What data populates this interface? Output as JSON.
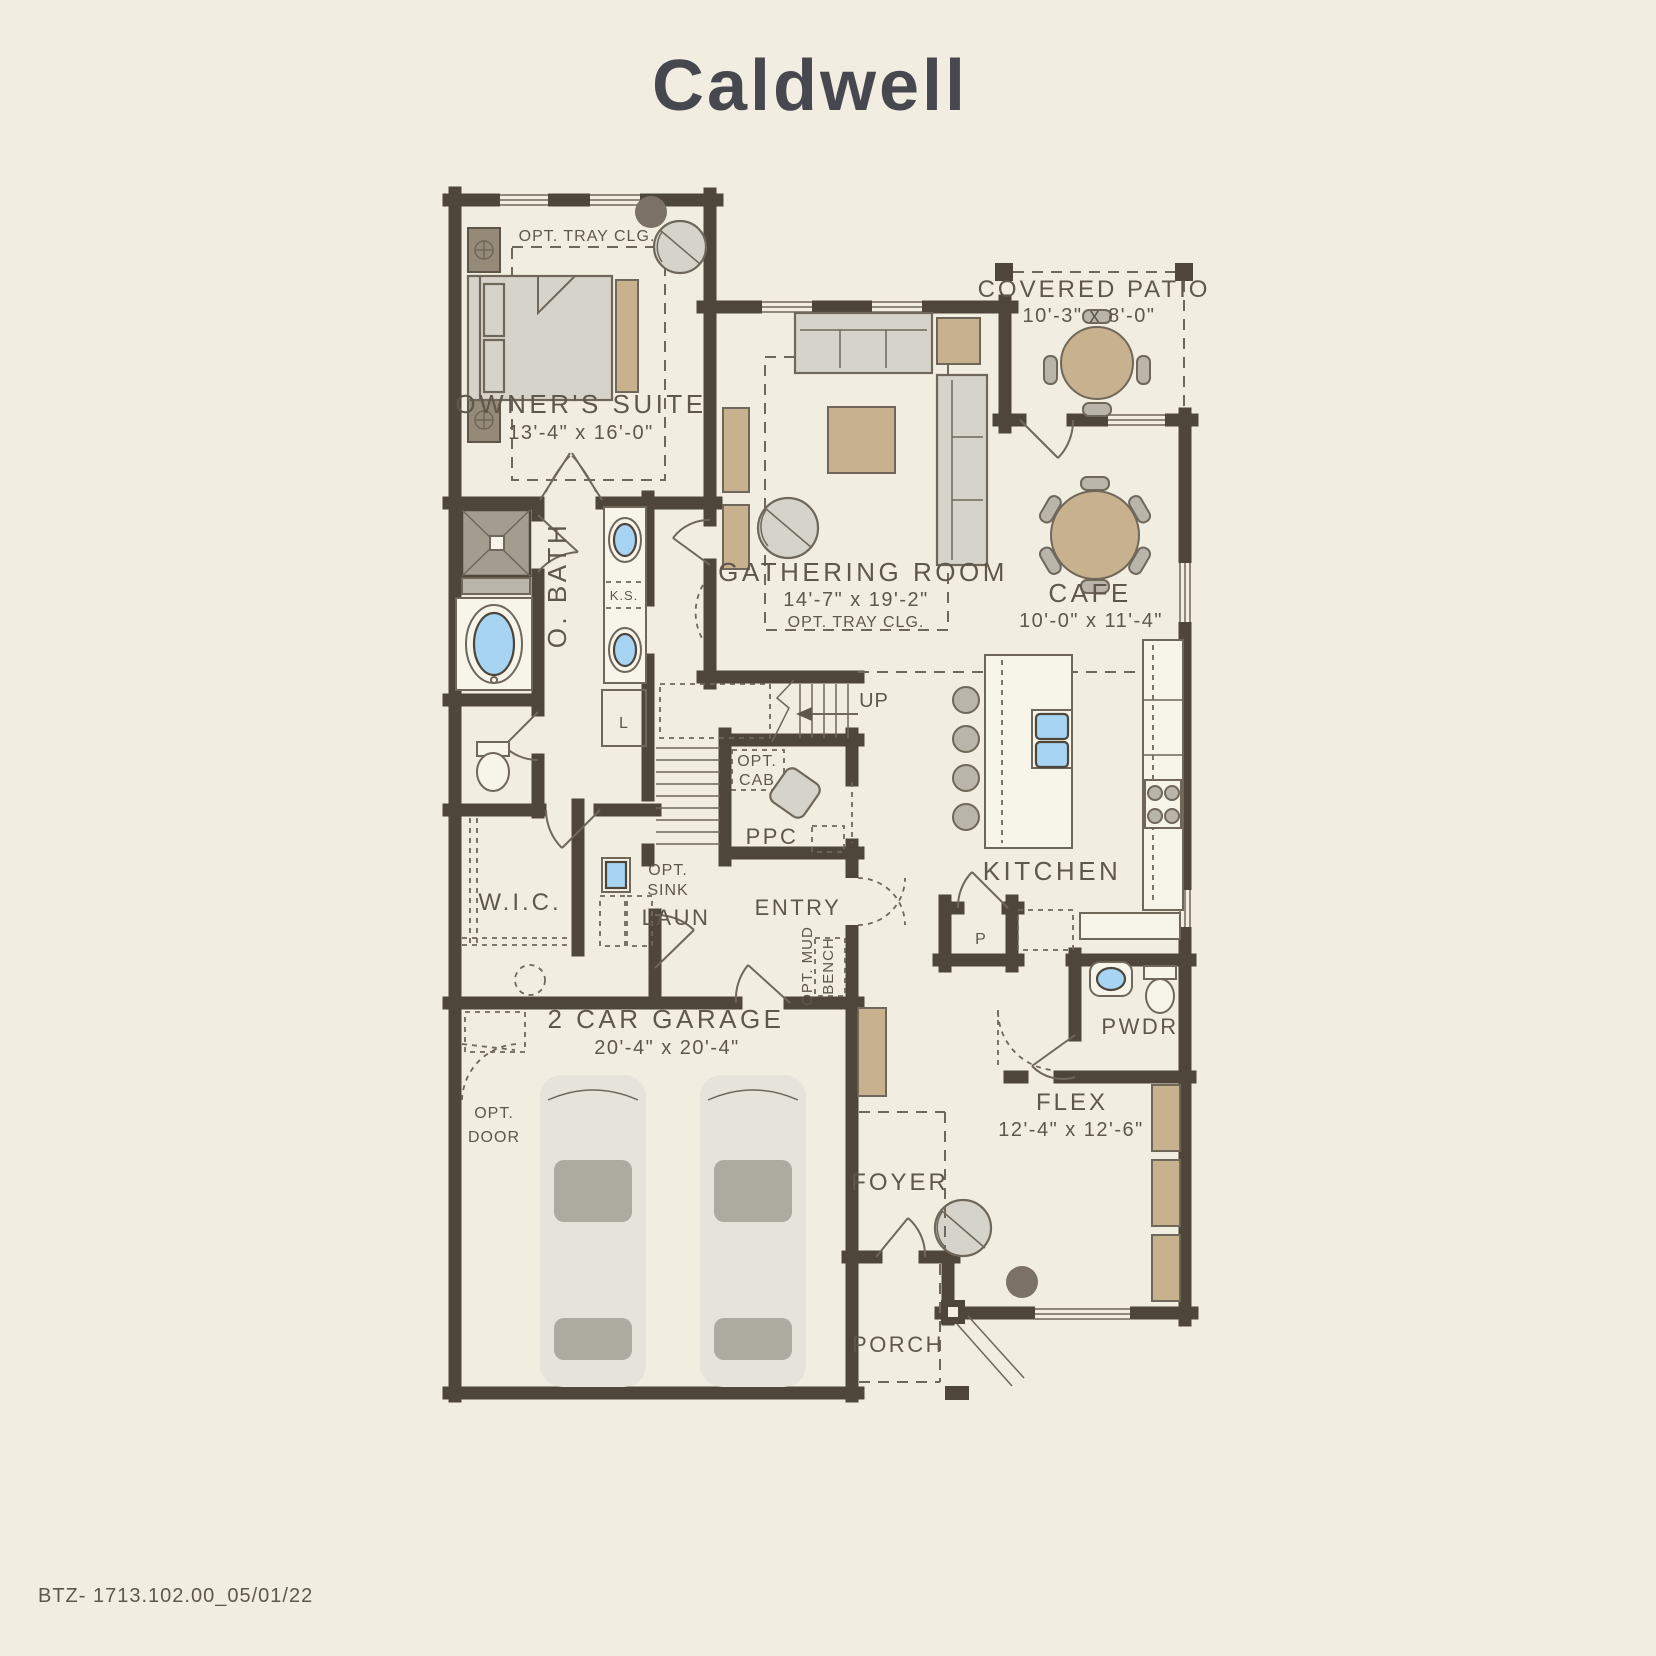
{
  "title": "Caldwell",
  "footer": {
    "code": "BTZ- 1713.102.00_05/01/22"
  },
  "colors": {
    "background": "#f1ede1",
    "wall": "#4e463a",
    "line": "#6f6759",
    "text": "#5f574b",
    "title_text": "#474750",
    "furniture_gray": "#d6d3ca",
    "furniture_tan": "#c8b18e",
    "fixture_blue": "#a6d4f2"
  },
  "rooms": {
    "owners_suite": {
      "label": "OWNER'S SUITE",
      "dims": "13'-4\" x 16'-0\""
    },
    "gathering": {
      "label": "GATHERING ROOM",
      "dims": "14'-7\" x 19'-2\""
    },
    "covered_patio": {
      "label": "COVERED PATIO",
      "dims": "10'-3\" x 8'-0\""
    },
    "cafe": {
      "label": "CAFE",
      "dims": "10'-0\" x 11'-4\""
    },
    "kitchen": {
      "label": "KITCHEN"
    },
    "owners_bath": {
      "label": "O. BATH"
    },
    "wic": {
      "label": "W.I.C."
    },
    "laundry": {
      "label": "LAUN"
    },
    "ppc": {
      "label": "PPC"
    },
    "entry": {
      "label": "ENTRY"
    },
    "garage": {
      "label": "2 CAR GARAGE",
      "dims": "20'-4\" x 20'-4\""
    },
    "powder": {
      "label": "PWDR"
    },
    "flex": {
      "label": "FLEX",
      "dims": "12'-4\" x 12'-6\""
    },
    "foyer": {
      "label": "FOYER"
    },
    "porch": {
      "label": "PORCH"
    }
  },
  "annotations": {
    "opt_tray_suite": "OPT. TRAY CLG.",
    "opt_tray_gathering": "OPT. TRAY CLG.",
    "up": "UP",
    "ks": "K.S.",
    "linen": "L",
    "pantry": "P",
    "opt_cab_line1": "OPT.",
    "opt_cab_line2": "CAB",
    "opt_sink_line1": "OPT.",
    "opt_sink_line2": "SINK",
    "opt_door_line1": "OPT.",
    "opt_door_line2": "DOOR",
    "opt_mud_line1": "OPT. MUD",
    "opt_mud_line2": "BENCH"
  }
}
